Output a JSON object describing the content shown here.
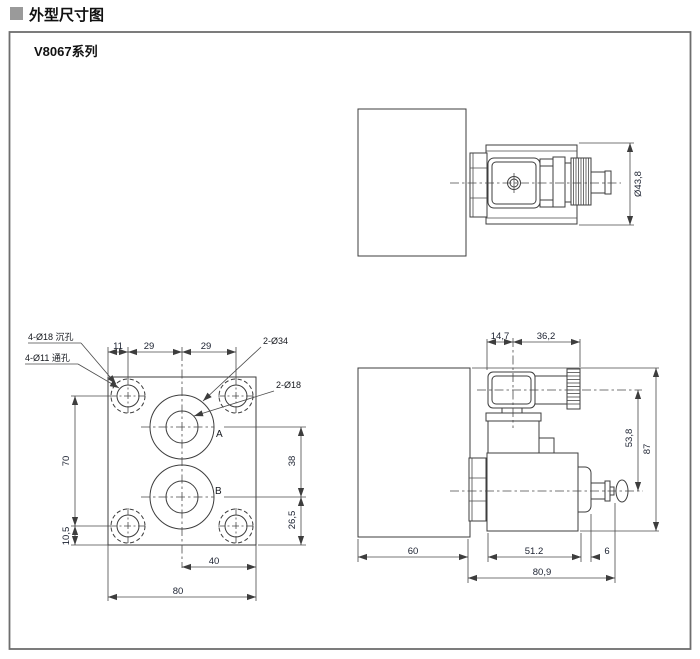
{
  "header": {
    "title": "外型尺寸图"
  },
  "series_label": "V8067系列",
  "top_view": {
    "dia": "Ø43,8"
  },
  "front_view": {
    "counterbore": "4-Ø18 沉孔",
    "through_hole": "4-Ø11 通孔",
    "ports_large": "2-Ø34",
    "ports_small": "2-Ø18",
    "port_a": "A",
    "port_b": "B",
    "d11": "11",
    "d29a": "29",
    "d29b": "29",
    "d70": "70",
    "d105": "10,5",
    "d38": "38",
    "d265": "26,5",
    "d40": "40",
    "d80": "80"
  },
  "side_view": {
    "d147": "14,7",
    "d362": "36,2",
    "d538": "53,8",
    "d87": "87",
    "d60": "60",
    "d512": "51.2",
    "d6": "6",
    "d809": "80,9"
  },
  "colors": {
    "line": "#3d3d3d",
    "dim_text": "#1b2130",
    "title_text": "#111111",
    "bullet": "#9a9a9a",
    "border": "#6e6e6e",
    "background": "#ffffff"
  }
}
